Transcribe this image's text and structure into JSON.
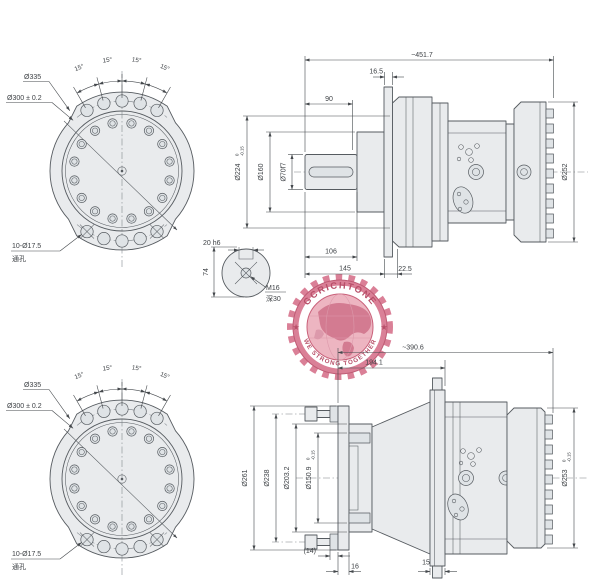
{
  "colors": {
    "background": "#ffffff",
    "line": "#565b60",
    "fill": "#e9ebed",
    "dimension_text": "#3d4145",
    "watermark_ring": "#c4506c",
    "watermark_globe": "#ecaebb",
    "watermark_land": "#cf6d86",
    "watermark_text": "#b03d59"
  },
  "flange_view": {
    "d_outer": "Ø335",
    "d_bolt_circle": "Ø300 ± 0.2",
    "angles": [
      "15°",
      "15°",
      "15°",
      "15°"
    ],
    "holes_callout": "10-Ø17.5",
    "holes_note": "通孔"
  },
  "side_view_top": {
    "overall_length": "~451.7",
    "flange_thickness": "16.5",
    "key_length": "90",
    "d_spigot": "Ø224",
    "d_spigot_tol_upper": "0",
    "d_spigot_tol_lower": "-0.15",
    "d_pilot": "Ø160",
    "d_shaft": "Ø70f7",
    "d_ring_gear": "Ø252",
    "shaft_length": "106",
    "front_length": "145",
    "rear_length": "22.5"
  },
  "shaft_end_view": {
    "key_width": "20 h6",
    "section_height": "74",
    "thread": "M16",
    "thread_depth": "深30"
  },
  "side_view_bottom": {
    "overall_length": "~390.6",
    "flange_position": "194.1",
    "d_outer_flange": "Ø261",
    "d_bolt_circle": "Ø238",
    "d_spigot": "Ø203.2",
    "d_pilot": "Ø150.9",
    "d_pilot_tol_upper": "0",
    "d_pilot_tol_lower": "-0.15",
    "d_ring_gear": "Ø253",
    "d_ring_gear_tol_upper": "0",
    "d_ring_gear_tol_lower": "-0.15",
    "stud_washer": "(14)",
    "plate_thickness": "16",
    "flange_thickness": "15"
  },
  "watermark": {
    "brand": "GCRICHTONE",
    "slogan": "WE STRONG TOGETHER",
    "star_left": "★",
    "star_right": "★"
  }
}
